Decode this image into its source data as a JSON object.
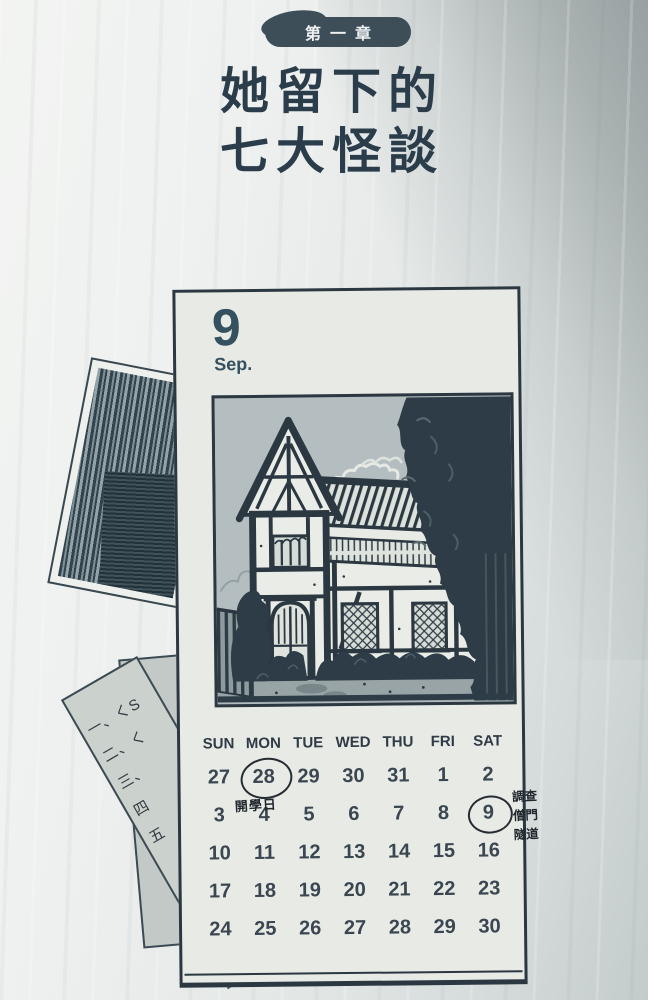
{
  "page": {
    "chapter_badge": "第一章",
    "title_line1": "她留下的",
    "title_line2": "七大怪談"
  },
  "calendar": {
    "month_number": "9",
    "month_abbr": "Sep.",
    "day_headers": [
      "SUN",
      "MON",
      "TUE",
      "WED",
      "THU",
      "FRI",
      "SAT"
    ],
    "weeks": [
      [
        "27",
        "28",
        "29",
        "30",
        "31",
        "1",
        "2"
      ],
      [
        "3",
        "4",
        "5",
        "6",
        "7",
        "8",
        "9"
      ],
      [
        "10",
        "11",
        "12",
        "13",
        "14",
        "15",
        "16"
      ],
      [
        "17",
        "18",
        "19",
        "20",
        "21",
        "22",
        "23"
      ],
      [
        "24",
        "25",
        "26",
        "27",
        "28",
        "29",
        "30"
      ]
    ],
    "annotations": {
      "school_day_circled_date": "28",
      "school_day_note": "開學日",
      "investigate_circled_date": "9",
      "investigate_note_lines": [
        "調查",
        "僧門",
        "隧道"
      ]
    }
  },
  "scrap_paper": {
    "list_fragments": [
      "一、くS",
      "二、く",
      "三、",
      "四",
      "五"
    ]
  },
  "illustrations": {
    "calendar_picture": "half-timbered-house-with-trees",
    "photo_scrap": "tiled-roof-ink-photo"
  },
  "colors": {
    "ink": "#2b3841",
    "badge_bg": "#3e4e59",
    "badge_text": "#eef1f1",
    "title_text": "#2b3d4a",
    "card_bg": "#e8eae6",
    "page_bg": "#e9eceb",
    "annotation_ink": "#20282e",
    "illustration_sky": "#b4bec1",
    "foliage": "#2d3c46"
  }
}
